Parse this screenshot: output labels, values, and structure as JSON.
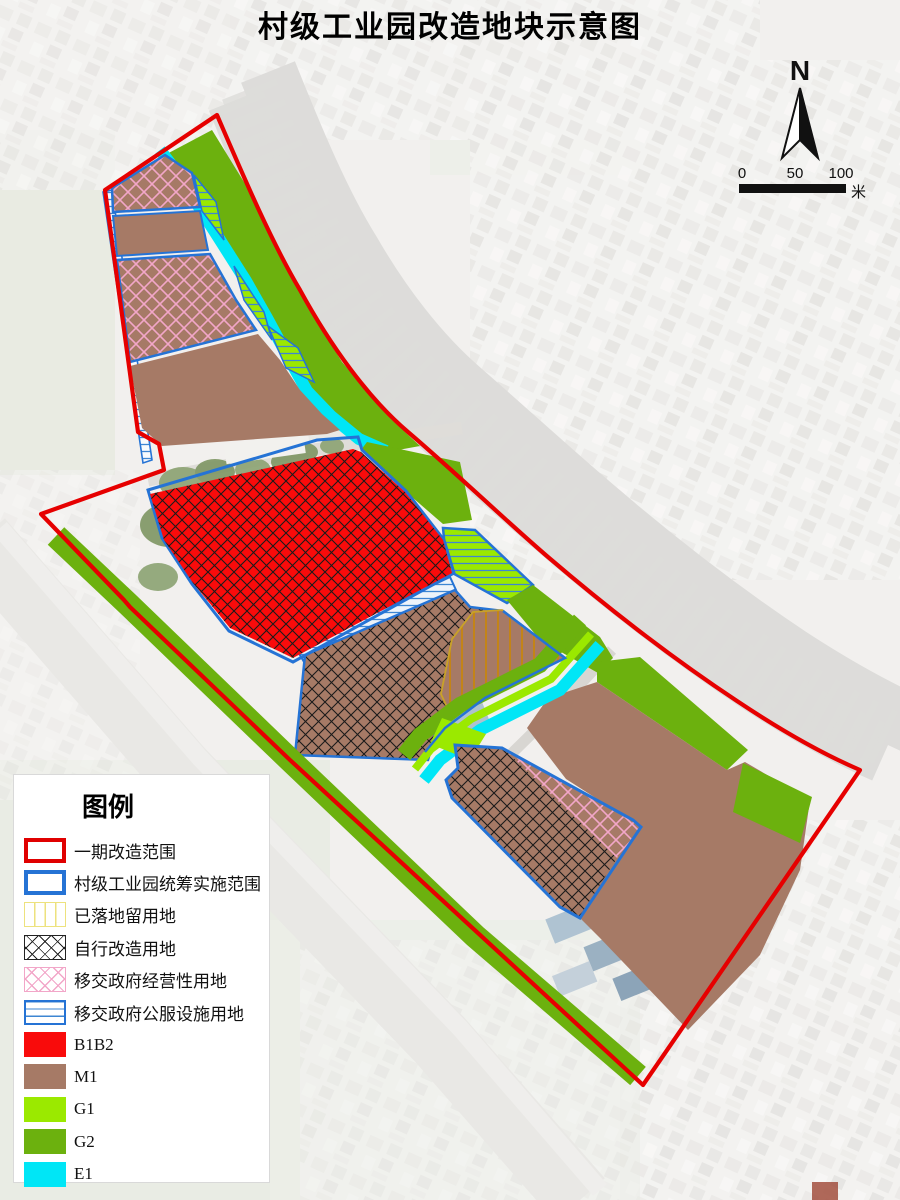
{
  "title": "村级工业园改造地块示意图",
  "compass": {
    "label": "N"
  },
  "scale_bar": {
    "tick_0": "0",
    "tick_50": "50",
    "tick_100": "100",
    "unit": "米"
  },
  "legend": {
    "title": "图例",
    "items": [
      {
        "label": "一期改造范围",
        "swatch": "outline-red"
      },
      {
        "label": "村级工业园统筹实施范围",
        "swatch": "outline-blue"
      },
      {
        "label": "已落地留用地",
        "swatch": "yellow-vlines"
      },
      {
        "label": "自行改造用地",
        "swatch": "black-crosshatch"
      },
      {
        "label": "移交政府经营性用地",
        "swatch": "pink-crosshatch"
      },
      {
        "label": "移交政府公服设施用地",
        "swatch": "blue-hlines"
      },
      {
        "label": "B1B2",
        "swatch": "fill-red"
      },
      {
        "label": "M1",
        "swatch": "fill-brown"
      },
      {
        "label": "G1",
        "swatch": "fill-light-green"
      },
      {
        "label": "G2",
        "swatch": "fill-green"
      },
      {
        "label": "E1",
        "swatch": "fill-cyan"
      }
    ]
  },
  "colors": {
    "boundary_red": "#E60000",
    "boundary_blue": "#2573D5",
    "b1b2": "#F90B0B",
    "m1": "#A67A66",
    "g1": "#9BE900",
    "g2": "#6CB10E",
    "e1": "#00E6F6",
    "hatch_black": "#1A1A1A",
    "hatch_pink": "#F2A6C8",
    "hatch_orange": "#C8860A",
    "hatch_blue": "#3E86D2",
    "hatch_yellow": "#EDE27E"
  }
}
